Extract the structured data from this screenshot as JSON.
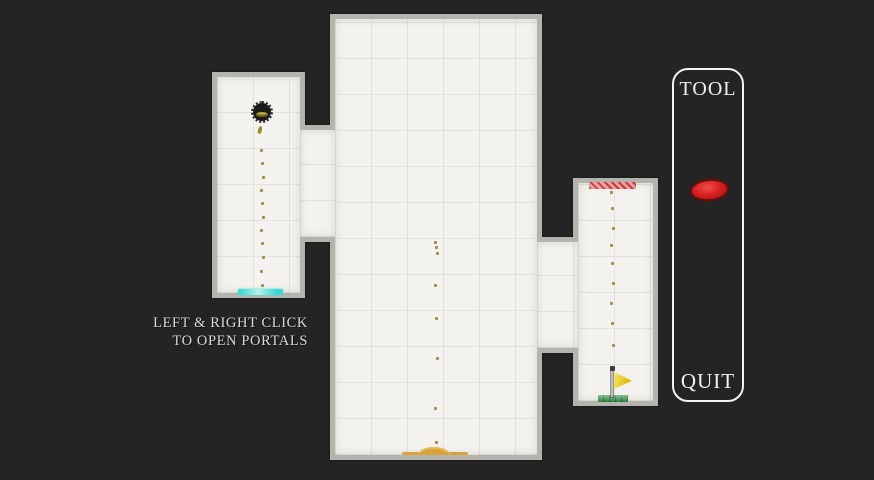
{
  "instructions": {
    "line1": "LEFT & RIGHT CLICK",
    "line2": "TO OPEN PORTALS"
  },
  "panel": {
    "tool_label": "TOOL",
    "quit_label": "QUIT"
  },
  "colors": {
    "background": "#242424",
    "wall": "#b5b3ae",
    "floor": "#f3f2ee",
    "portal_cyan": "#3fd8d2",
    "checkpoint_red": "#cf4c4c",
    "goal_green": "#3a9a50",
    "flag_yellow": "#f2cd08",
    "sand": "#d8a23c",
    "tool_blob": "#d31d1d",
    "trail_dot": "#8b7d2a",
    "text_color": "#dbdad6"
  },
  "game": {
    "player": {
      "x": 262,
      "y": 112,
      "radius": 9
    },
    "trails": [
      {
        "name": "left-room-fall-trail",
        "x": 262,
        "ys": [
          150,
          163,
          177,
          190,
          203,
          217,
          230,
          243,
          257,
          271,
          285
        ]
      },
      {
        "name": "center-room-fall-trail",
        "x": 436,
        "ys": [
          242,
          247,
          253,
          285,
          318,
          358,
          408,
          442
        ]
      },
      {
        "name": "right-room-fall-trail",
        "x": 612,
        "ys": [
          192,
          208,
          228,
          245,
          263,
          283,
          303,
          323,
          345,
          367
        ]
      }
    ]
  }
}
